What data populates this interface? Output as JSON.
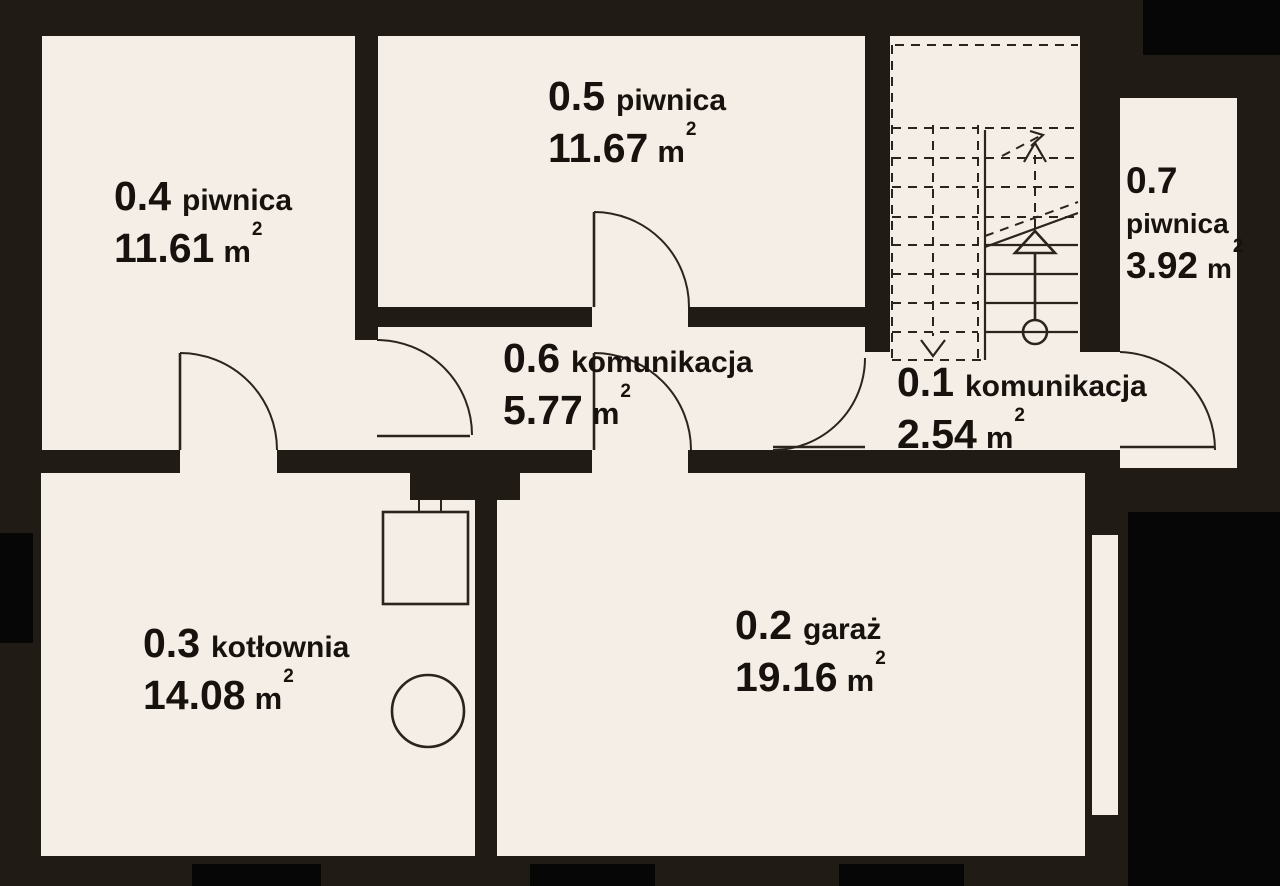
{
  "plan_type": "floor-plan",
  "language": "pl",
  "rooms": [
    {
      "number": "0.4",
      "name": "piwnica",
      "area": "11.61",
      "unit": "m",
      "sup": "2"
    },
    {
      "number": "0.5",
      "name": "piwnica",
      "area": "11.67",
      "unit": "m",
      "sup": "2"
    },
    {
      "number": "0.7",
      "name": "piwnica",
      "area": "3.92",
      "unit": "m",
      "sup": "2"
    },
    {
      "number": "0.6",
      "name": "komunikacja",
      "area": "5.77",
      "unit": "m",
      "sup": "2"
    },
    {
      "number": "0.1",
      "name": "komunikacja",
      "area": "2.54",
      "unit": "m",
      "sup": "2"
    },
    {
      "number": "0.3",
      "name": "kotłownia",
      "area": "14.08",
      "unit": "m",
      "sup": "2"
    },
    {
      "number": "0.2",
      "name": "garaż",
      "area": "19.16",
      "unit": "m",
      "sup": "2"
    }
  ],
  "colors": {
    "wall": "#211b15",
    "floor": "#f4eee6",
    "opening_black": "#060606",
    "line": "#2a241d",
    "text": "#17120d"
  },
  "symbols": {
    "staircase": "stairs with up and down direction arrows",
    "boiler": "boiler unit in kotłownia",
    "drain": "round floor drain in kotłownia"
  }
}
